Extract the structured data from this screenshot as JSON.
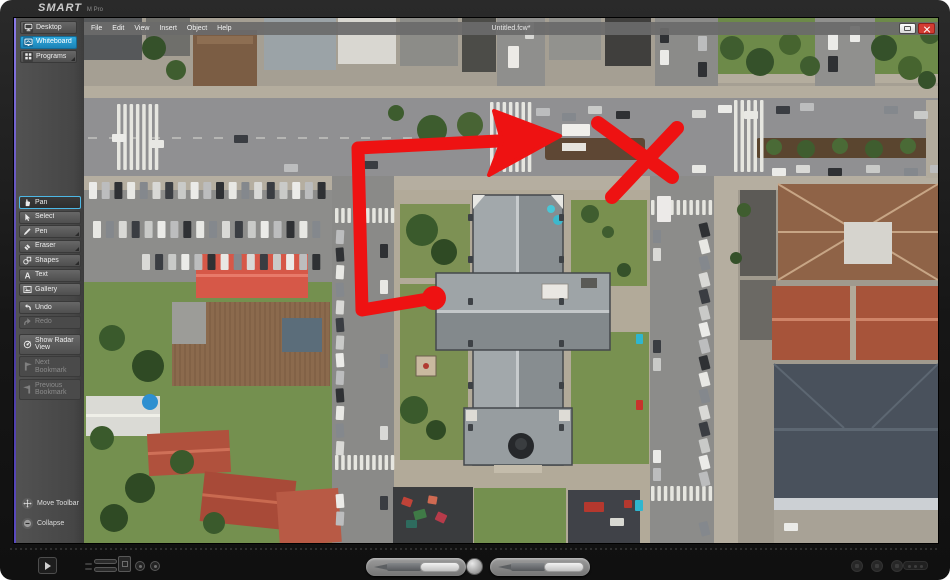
{
  "device": {
    "brand": "SMART",
    "model": "M Pro"
  },
  "window": {
    "title": "Untitled.fcw*",
    "controls": {
      "restore": "Restore",
      "close": "Close"
    }
  },
  "menu_bar": {
    "items": [
      {
        "label": "File"
      },
      {
        "label": "Edit"
      },
      {
        "label": "View"
      },
      {
        "label": "Insert"
      },
      {
        "label": "Object"
      },
      {
        "label": "Help"
      }
    ]
  },
  "toolbar": {
    "top": [
      {
        "label": "Desktop",
        "active": false
      },
      {
        "label": "Whiteboard",
        "active": true
      },
      {
        "label": "Programs",
        "has_submenu": true
      }
    ],
    "tools": [
      {
        "label": "Pan",
        "selected": true
      },
      {
        "label": "Select"
      },
      {
        "label": "Pen",
        "has_submenu": true
      },
      {
        "label": "Eraser",
        "has_submenu": true
      },
      {
        "label": "Shapes",
        "has_submenu": true
      },
      {
        "label": "Text"
      },
      {
        "label": "Gallery"
      },
      {
        "label": "Undo"
      },
      {
        "label": "Redo",
        "disabled": true
      },
      {
        "label": "Show Radar View"
      },
      {
        "label": "Next Bookmark",
        "disabled": true
      },
      {
        "label": "Previous Bookmark",
        "disabled": true
      }
    ],
    "footer": [
      {
        "label": "Move Toolbar"
      },
      {
        "label": "Collapse"
      }
    ]
  },
  "canvas": {
    "annotations": [
      {
        "name": "route-arrow",
        "type": "ink"
      },
      {
        "name": "x-mark",
        "type": "ink"
      }
    ]
  },
  "colors": {
    "accent_blue": "#2fa8dc",
    "selection_blue": "#4db8e6",
    "close_red": "#d23b32",
    "ink_red": "#ee1212"
  }
}
